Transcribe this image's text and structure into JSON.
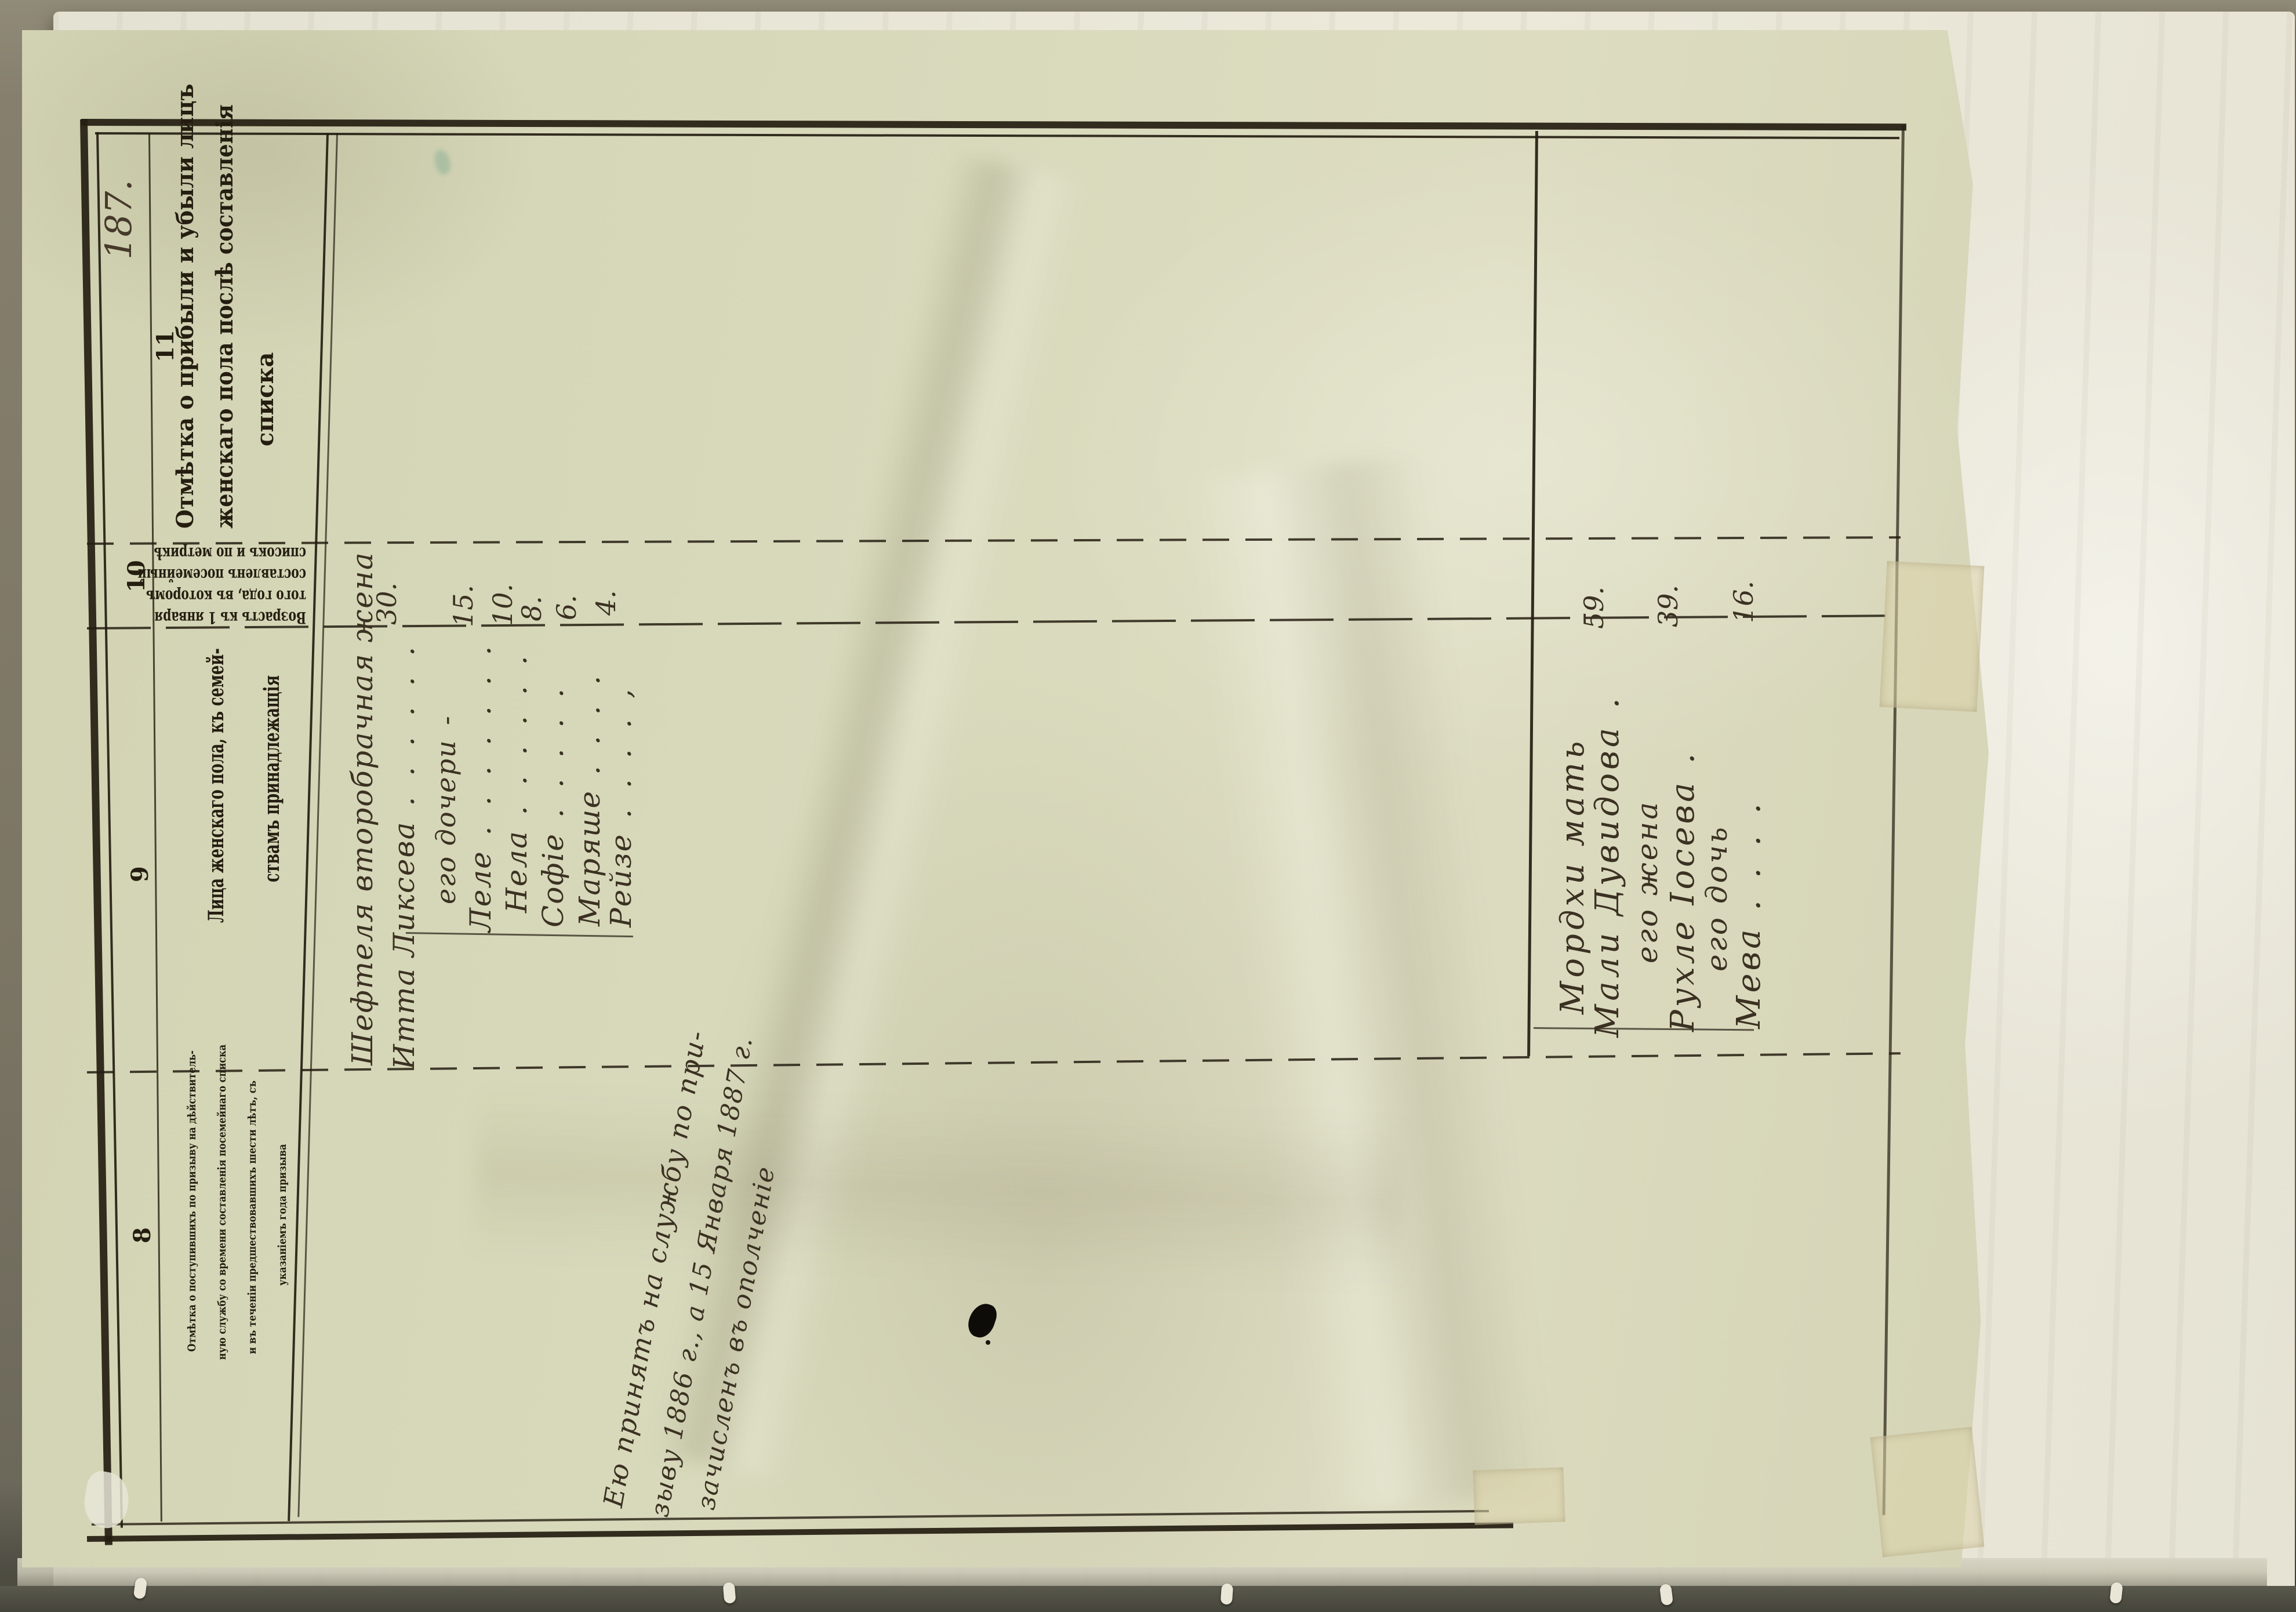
{
  "photo": {
    "page_number": "187."
  },
  "table": {
    "columns": [
      {
        "number": "11",
        "header_lines": [
          "Отмѣтка о прибыли и убыли лицъ",
          "женскаго пола послѣ составленія",
          "списка"
        ]
      },
      {
        "number": "10",
        "header_lines": [
          "Возрастъ къ 1 января",
          "того года, въ которомъ",
          "составленъ посемейный",
          "списокъ и по метрикѣ"
        ]
      },
      {
        "number": "9",
        "header_lines": [
          "Лица женскаго пола, къ семей-",
          "ствамъ принадлежащія"
        ]
      },
      {
        "number": "8",
        "header_lines": [
          "Отмѣтка о поступившихъ по призыву на дѣйствитель-",
          "ную службу со времени составленія посемейнаго списка",
          "и въ теченіи предшествовавшихъ шести лѣтъ, съ",
          "указаніемъ года призыва"
        ]
      }
    ]
  },
  "entries": {
    "family1": {
      "rows": [
        {
          "name": "Шефтеля второбрачная жена",
          "dots": "",
          "age": ""
        },
        {
          "name": "Итта Ликсева",
          "dots": " .  .  .  .  .  .",
          "age": "30."
        },
        {
          "name": "его дочери",
          "dots": "  -",
          "age": ""
        },
        {
          "name": "Леле",
          "dots": " .   .   .   .   .   .   .",
          "age": "15."
        },
        {
          "name": "Нела",
          "dots": " .   .   .   .   .   .",
          "age": "10."
        },
        {
          "name": "Софіе",
          "dots": " .   .   .   .   .",
          "age": "8."
        },
        {
          "name": "Маряше",
          "dots": " .   .   .   .",
          "age": "6."
        },
        {
          "name": "Рейзе",
          "dots": " .   .   .   .  ,",
          "age": "4."
        }
      ]
    },
    "family2": {
      "rows": [
        {
          "name": "Мордхи мать",
          "dots": "",
          "age": ""
        },
        {
          "name": "Мали Дувидова",
          "dots": " .",
          "age": "59."
        },
        {
          "name": "его жена",
          "dots": "",
          "age": ""
        },
        {
          "name": "Рухле Іосева",
          "dots": " .",
          "age": "39."
        },
        {
          "name": "его дочь",
          "dots": "",
          "age": ""
        },
        {
          "name": "Мева",
          "dots": " .   .   .   .",
          "age": "16."
        }
      ]
    }
  },
  "note_column8": {
    "lines": [
      "Ею принятъ на службу по при-",
      "зыву 1886 г., а 15 Января 1887 г.",
      "зачисленъ въ ополченіе"
    ]
  },
  "colors": {
    "paper": "#d7d8ba",
    "under_paper": "#eae8da",
    "ink_print": "#241d10",
    "ink_hand": "#3b3122",
    "backing": "#8b8574"
  }
}
